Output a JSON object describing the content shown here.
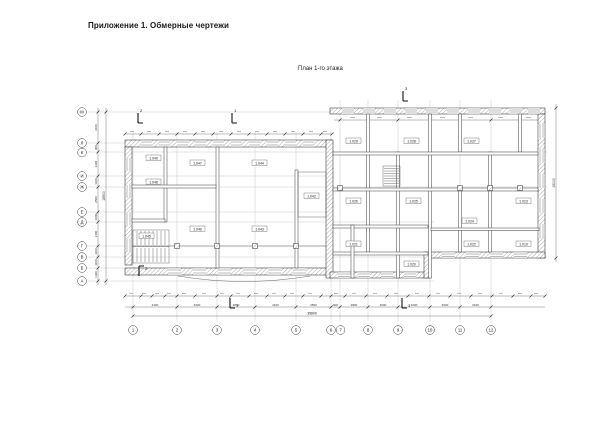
{
  "header": {
    "title": "Приложение 1. Обмерные чертежи"
  },
  "drawing": {
    "title": "План 1-го этажа"
  },
  "axes": {
    "bottom": [
      "1",
      "2",
      "3",
      "4",
      "5",
      "6",
      "7",
      "8",
      "9",
      "10",
      "11",
      "12"
    ],
    "left": [
      "М",
      "Л",
      "К",
      "И",
      "Ж",
      "Е",
      "Д",
      "Г",
      "В",
      "Б",
      "А"
    ]
  },
  "sections": {
    "left": "2",
    "mid": "1",
    "right": "3"
  },
  "rooms": [
    "1.049",
    "1.048",
    "1.047",
    "1.046",
    "1.045",
    "1.044",
    "1.043",
    "1.042",
    "1.029",
    "1.028",
    "1.027",
    "1.026",
    "1.025",
    "1.024",
    "1.023",
    "1.022",
    "1.021",
    "1.020",
    "1.019"
  ],
  "dimensions": {
    "axis_spans_bottom": [
      "4400",
      "4000",
      "3800",
      "4100",
      "3500",
      "900",
      "2800",
      "3000",
      "3200",
      "3000",
      "3100"
    ],
    "overall_bottom": "35800",
    "axis_spans_left": [
      "3100",
      "900",
      "2400",
      "1100",
      "2500",
      "1000",
      "2400",
      "1100",
      "1100",
      "1300"
    ],
    "overall_left": "16900",
    "overall_right": "15000"
  }
}
